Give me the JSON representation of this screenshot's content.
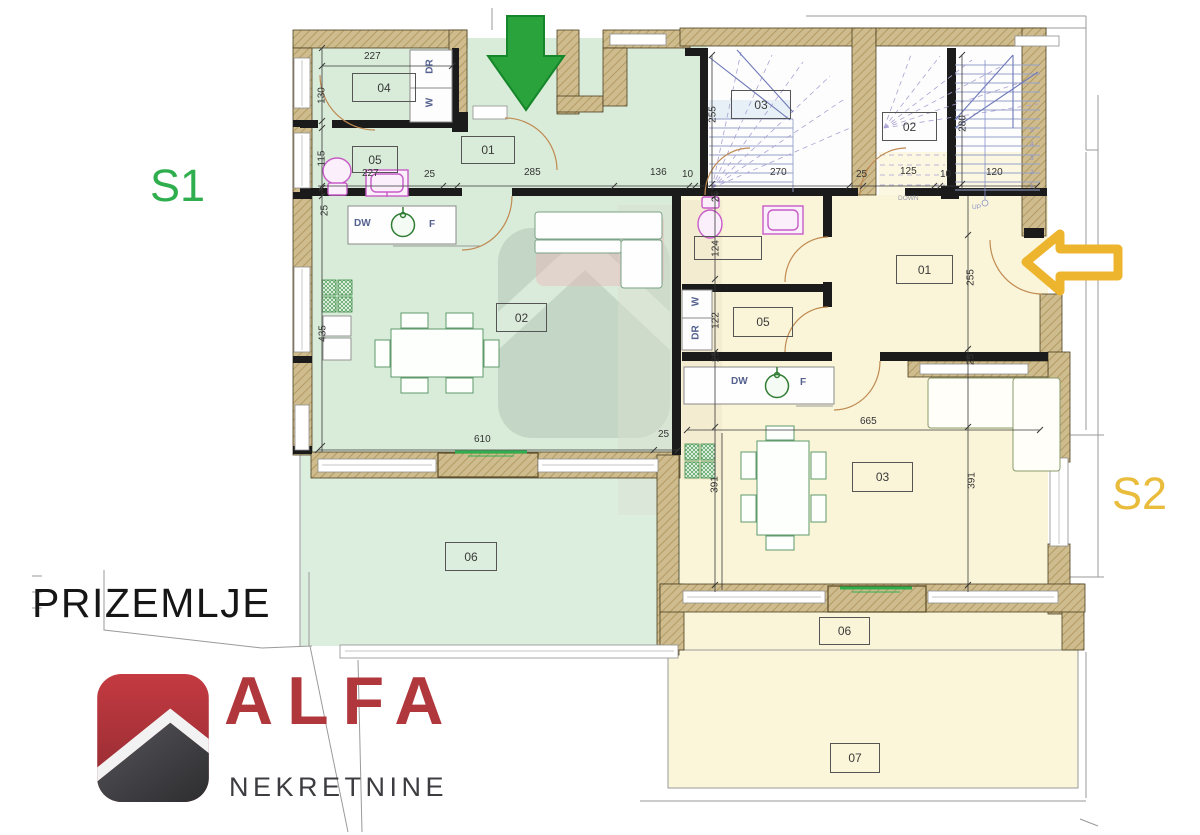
{
  "floor_label": "PRIZEMLJE",
  "units": {
    "s1": "S1",
    "s2": "S2"
  },
  "logo": {
    "brand": "ALFA",
    "subtitle": "NEKRETNINE"
  },
  "rooms": {
    "s1_hall": "01",
    "s1_living": "02",
    "s1_stairs": "03",
    "s1_bath": "04",
    "s1_wc": "05",
    "s1_terrace": "06",
    "s2_hall": "01",
    "s2_stairs": "02",
    "s2_living": "03",
    "s2_bath": "",
    "s2_wardrobe": "05",
    "s2_terrace": "06",
    "s2_garden": "07"
  },
  "fixtures": {
    "dishwasher": "DW",
    "fridge": "F",
    "washer": "W",
    "dryer": "DR",
    "down": "DOWN",
    "up": "UP"
  },
  "stair_numbers": [
    "1",
    "2",
    "3",
    "4",
    "5"
  ],
  "dims": {
    "top_width": "227",
    "chain": [
      "227",
      "25",
      "285",
      "136",
      "10",
      "270",
      "25",
      "125",
      "10",
      "120"
    ],
    "left": {
      "bath": "130",
      "wc": "115",
      "wall": "25",
      "living": "435"
    },
    "s1_stairs": "255",
    "s2_stairs": "280",
    "s2_left": {
      "wall_top": "25",
      "bath": "124",
      "wardrobe": "122",
      "wall_mid": "25",
      "living": "391"
    },
    "s2_right": {
      "hall": "255",
      "wall": "25",
      "living": "391"
    },
    "bottom": {
      "s1_terrace": "610",
      "wall": "25",
      "s2_living": "665"
    }
  },
  "colors": {
    "s1_fill": "#d9ecd9",
    "s2_fill": "#faf5d8",
    "s1_accent": "#2fae4e",
    "s2_accent": "#e9bc3b",
    "wall": "#cfbc8e",
    "logo_red": "#b0383c",
    "logo_dark": "#3d3d41",
    "door": "#c08a52"
  }
}
